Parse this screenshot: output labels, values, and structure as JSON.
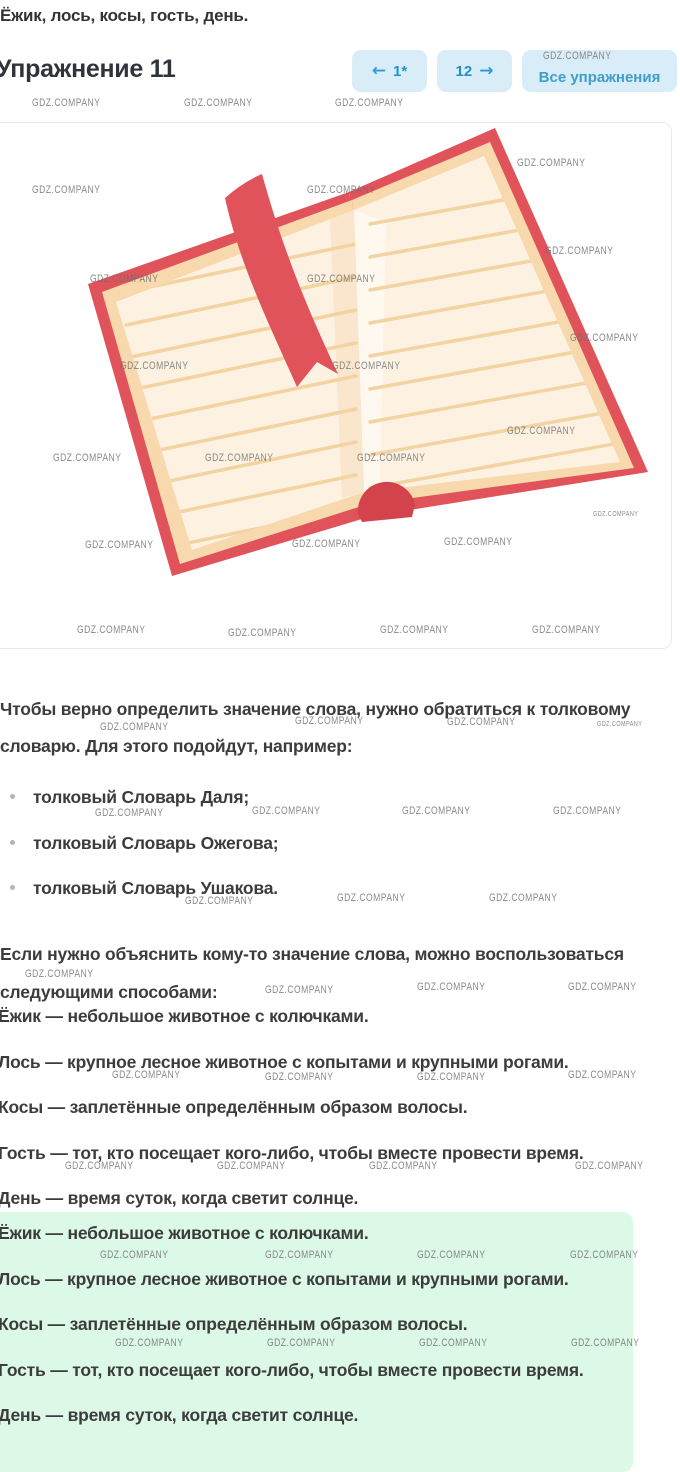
{
  "theme": {
    "accent_blue": "#2e9ad9",
    "accent_number": "#2191c9",
    "button_bg": "#d9edf8",
    "link_blue": "#3f9fca",
    "heading_color": "#2f333b",
    "text_color": "#3c3c3c",
    "answer_green": "#dcf8e7",
    "watermark_gray": "#6f6f6f",
    "border_gray": "#e9e9e9",
    "book_red": "#e0535a",
    "book_red_dark": "#d2434b",
    "page_cream": "#fdf2e2",
    "page_edge": "#f8d9ad",
    "page_line": "#f3d3a2"
  },
  "top": {
    "answer_line": "Ёжик, лось, косы, гость, день."
  },
  "header": {
    "title": "Упражнение 11",
    "prev_arrow": "←",
    "prev_label": "1*",
    "next_label": "12",
    "next_arrow": "→",
    "all_exercises_label": "Все упражнения"
  },
  "illustration": {
    "alt": "open-book-with-red-bookmark"
  },
  "content": {
    "intro": "Чтобы верно определить значение слова, нужно обратиться к толковому словарю. Для этого подойдут, например:",
    "dictionaries": [
      "толковый Словарь Даля;",
      "толковый Словарь Ожегова;",
      "толковый Словарь Ушакова."
    ],
    "explain_intro": "Если нужно объяснить кому-то значение слова, можно воспользоваться следующими способами:",
    "definitions": [
      "Ёжик — небольшое животное с колючками.",
      "Лось — крупное лесное животное с копытами и крупными рогами.",
      "Косы — заплетённые определённым образом волосы.",
      "Гость — тот, кто посещает кого-либо, чтобы вместе провести время.",
      "День — время суток, когда светит солнце."
    ],
    "answer_definitions": [
      "Ёжик — небольшое животное с колючками.",
      "Лось — крупное лесное животное с копытами и крупными рогами.",
      "Косы — заплетённые определённым образом волосы.",
      "Гость — тот, кто посещает кого-либо, чтобы вместе провести время.",
      "День — время суток, когда светит солнце."
    ]
  },
  "watermarks": {
    "label": "GDZ.COMPANY",
    "positions": [
      [
        543,
        50
      ],
      [
        32,
        97
      ],
      [
        184,
        97
      ],
      [
        335,
        97
      ],
      [
        517,
        157
      ],
      [
        32,
        184
      ],
      [
        307,
        184
      ],
      [
        545,
        245
      ],
      [
        90,
        273
      ],
      [
        307,
        273
      ],
      [
        570,
        332
      ],
      [
        120,
        360
      ],
      [
        332,
        360
      ],
      [
        507,
        425
      ],
      [
        53,
        452
      ],
      [
        205,
        452
      ],
      [
        357,
        452
      ],
      [
        593,
        511,
        7
      ],
      [
        85,
        539
      ],
      [
        292,
        538
      ],
      [
        444,
        536
      ],
      [
        77,
        624
      ],
      [
        228,
        627
      ],
      [
        380,
        624
      ],
      [
        532,
        624
      ],
      [
        100,
        721
      ],
      [
        295,
        715
      ],
      [
        447,
        716
      ],
      [
        597,
        721,
        7
      ],
      [
        95,
        807
      ],
      [
        252,
        805
      ],
      [
        402,
        805
      ],
      [
        553,
        805
      ],
      [
        185,
        895
      ],
      [
        337,
        892
      ],
      [
        489,
        892
      ],
      [
        25,
        968
      ],
      [
        265,
        984
      ],
      [
        417,
        981
      ],
      [
        568,
        981
      ],
      [
        112,
        1069
      ],
      [
        265,
        1071
      ],
      [
        417,
        1071
      ],
      [
        568,
        1069
      ],
      [
        65,
        1160
      ],
      [
        217,
        1160
      ],
      [
        369,
        1160
      ],
      [
        575,
        1160
      ],
      [
        100,
        1249
      ],
      [
        265,
        1249
      ],
      [
        417,
        1249
      ],
      [
        570,
        1249
      ],
      [
        115,
        1337
      ],
      [
        267,
        1337
      ],
      [
        419,
        1337
      ],
      [
        571,
        1337
      ]
    ]
  }
}
